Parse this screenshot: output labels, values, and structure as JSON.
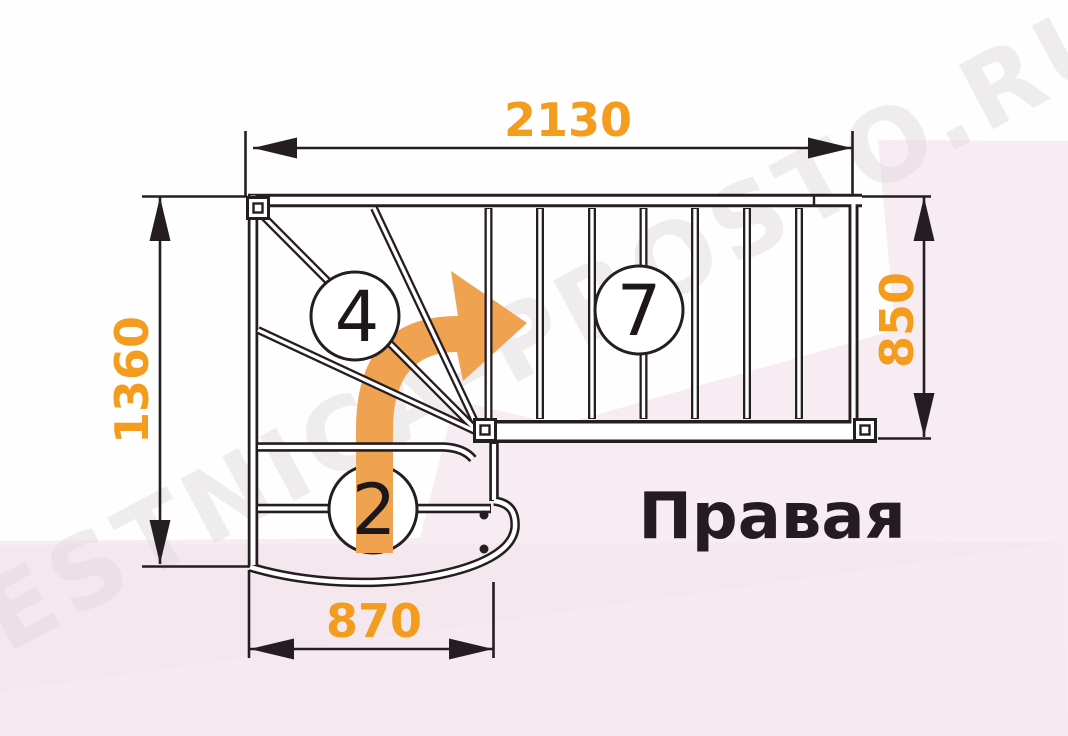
{
  "diagram": {
    "title_note": "L-shaped staircase plan",
    "dimensions": {
      "top": {
        "value": "2130"
      },
      "left": {
        "value": "1360"
      },
      "right": {
        "value": "850"
      },
      "bottom": {
        "value": "870"
      }
    },
    "flights": {
      "winder_steps": "4",
      "upper_steps": "7",
      "lower_steps": "2"
    },
    "orientation_label": "Правая",
    "watermark": "LESTNICA-PROSTO.RU",
    "colors": {
      "dimension_text": "#f39c1e",
      "arrow": "#efa24f",
      "line": "#241e22",
      "background_pink": "#f7ecf2",
      "background_white": "#fefefe"
    }
  }
}
